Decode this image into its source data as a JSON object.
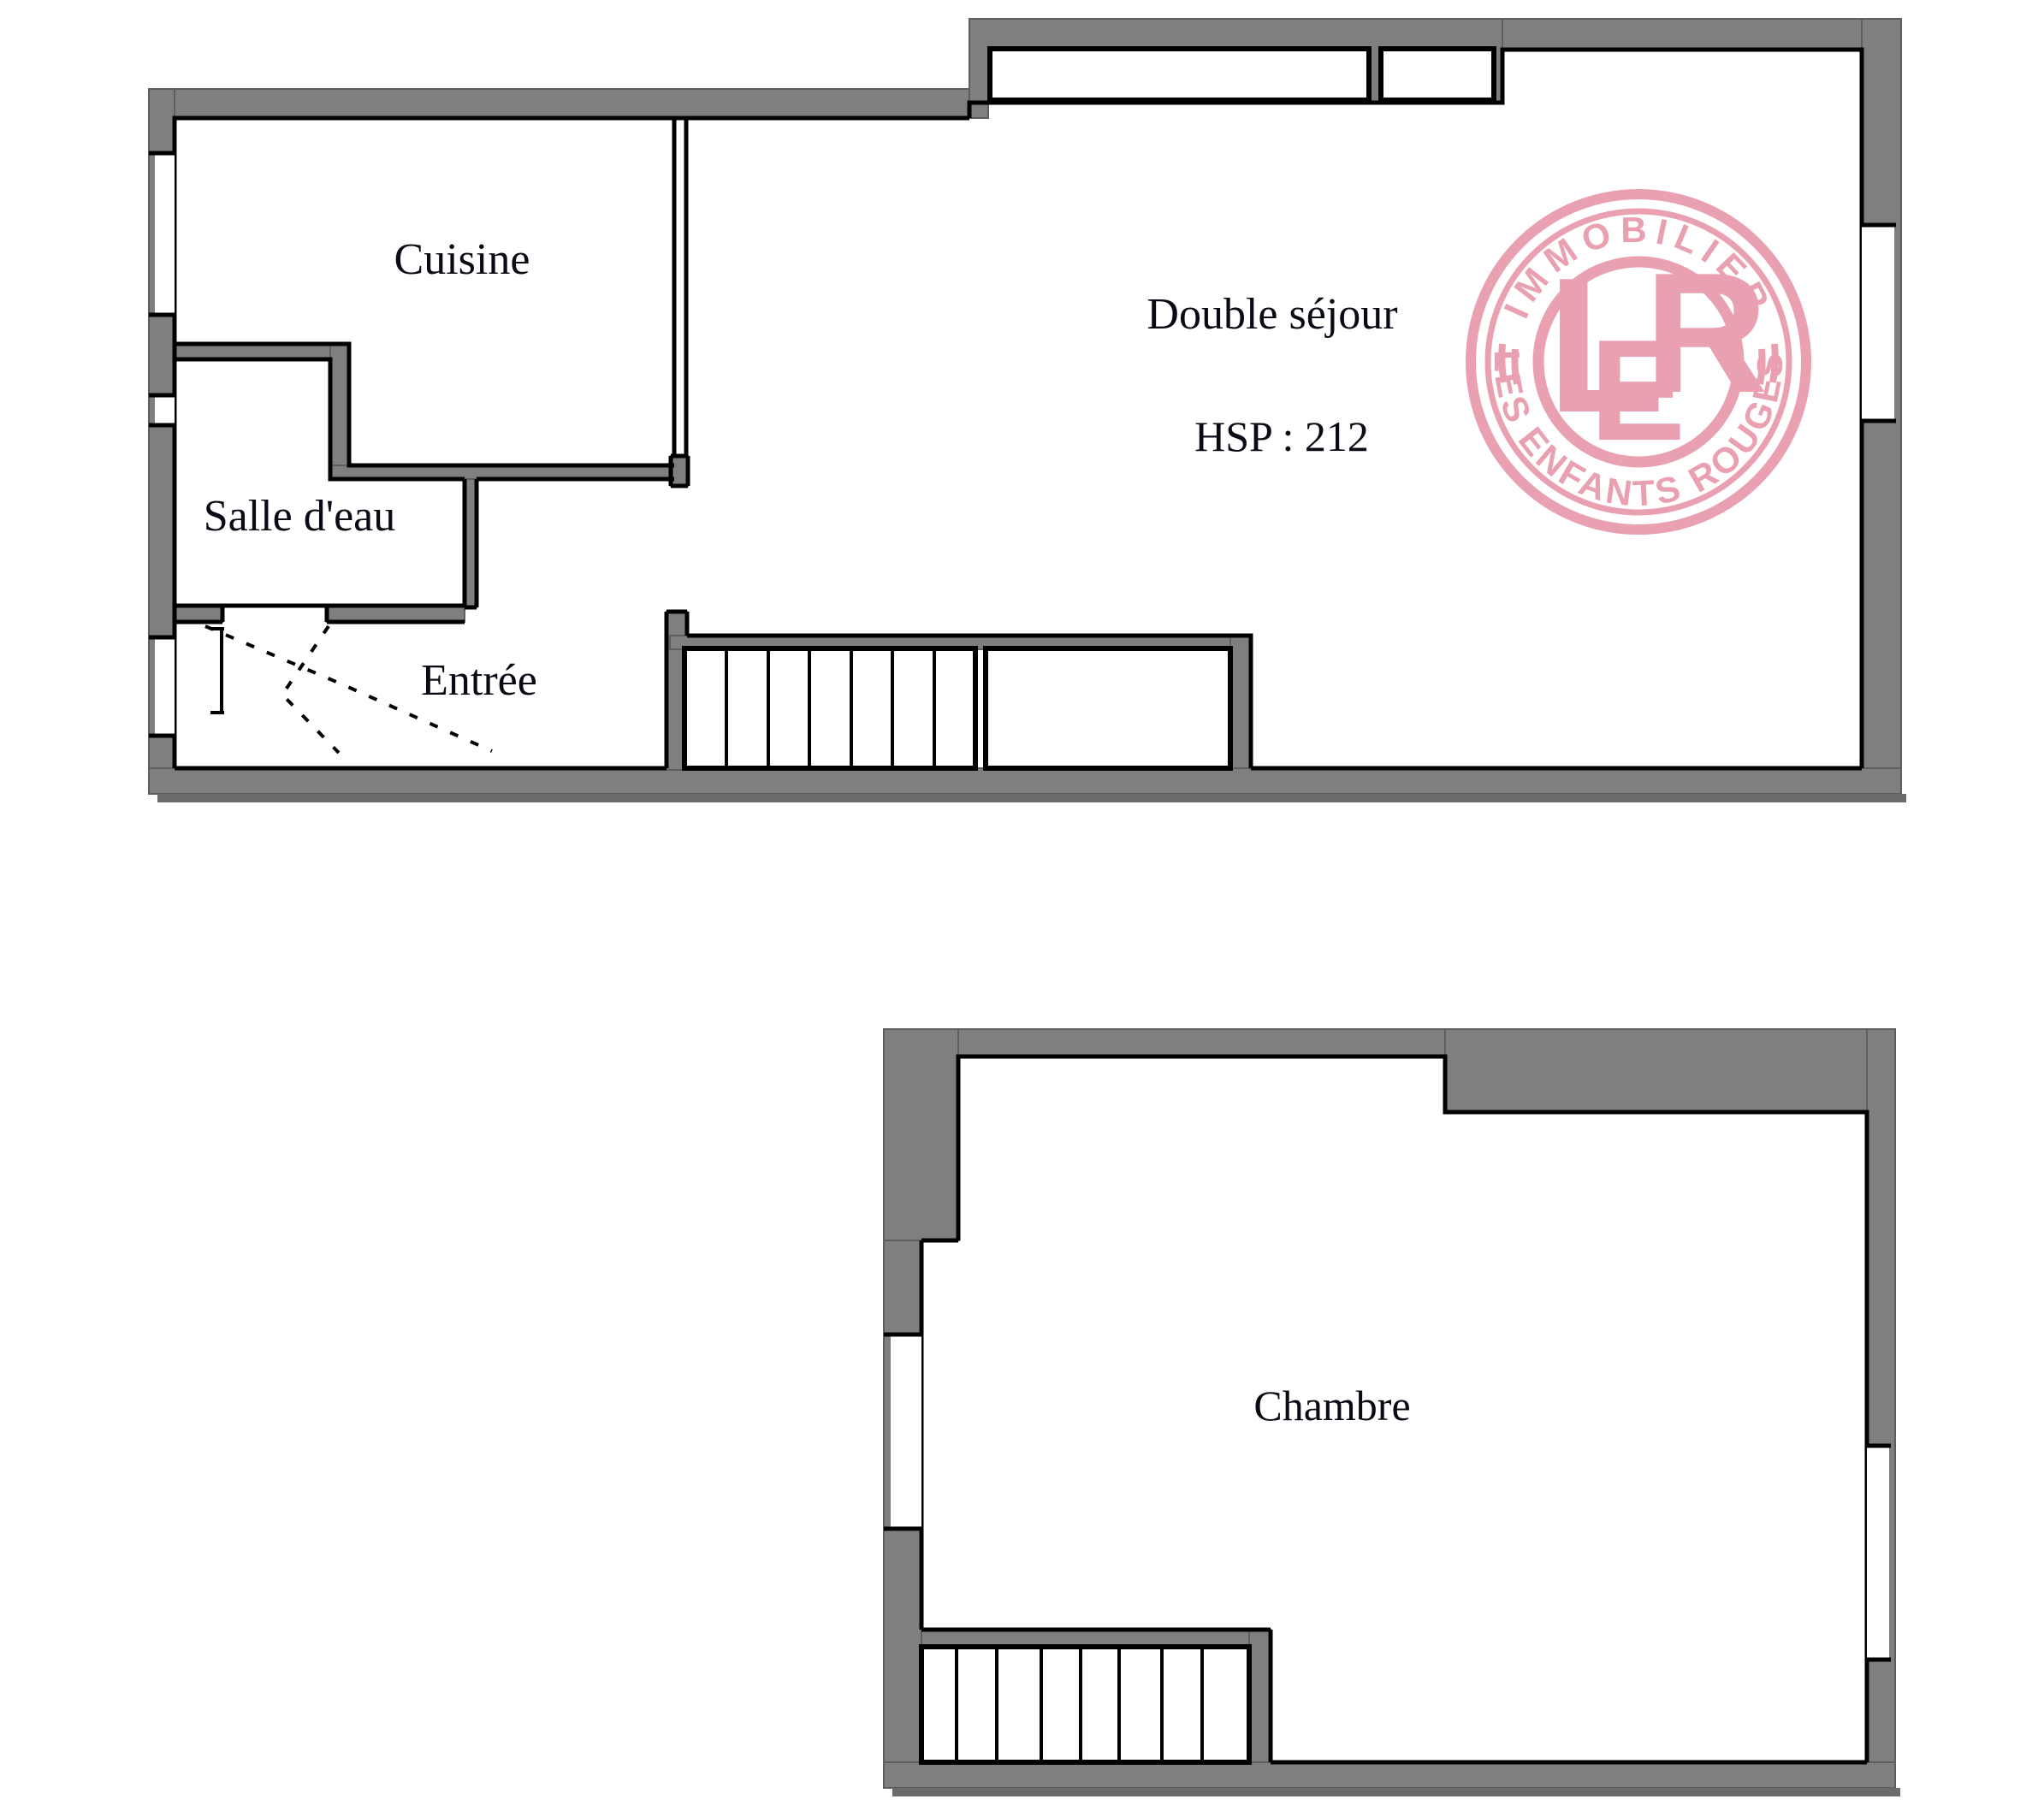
{
  "plans": {
    "upper": {
      "labels": {
        "cuisine": "Cuisine",
        "salle_deau": "Salle d'eau",
        "entree": "Entrée",
        "sejour": "Double séjour",
        "hsp": "HSP : 212"
      }
    },
    "lower": {
      "labels": {
        "chambre": "Chambre"
      }
    }
  },
  "logo": {
    "arc_top": "IMMOBILIER",
    "arc_bottom": "LES ENFANTS ROUGES",
    "monogram_l": "L",
    "monogram_e": "E",
    "monogram_r": "R"
  },
  "colors": {
    "wall": "#7F7F7F",
    "wall_edge": "#5E5E5E",
    "line": "#000000",
    "logo_pink": "#E9A1B1",
    "background": "#FFFFFF"
  }
}
